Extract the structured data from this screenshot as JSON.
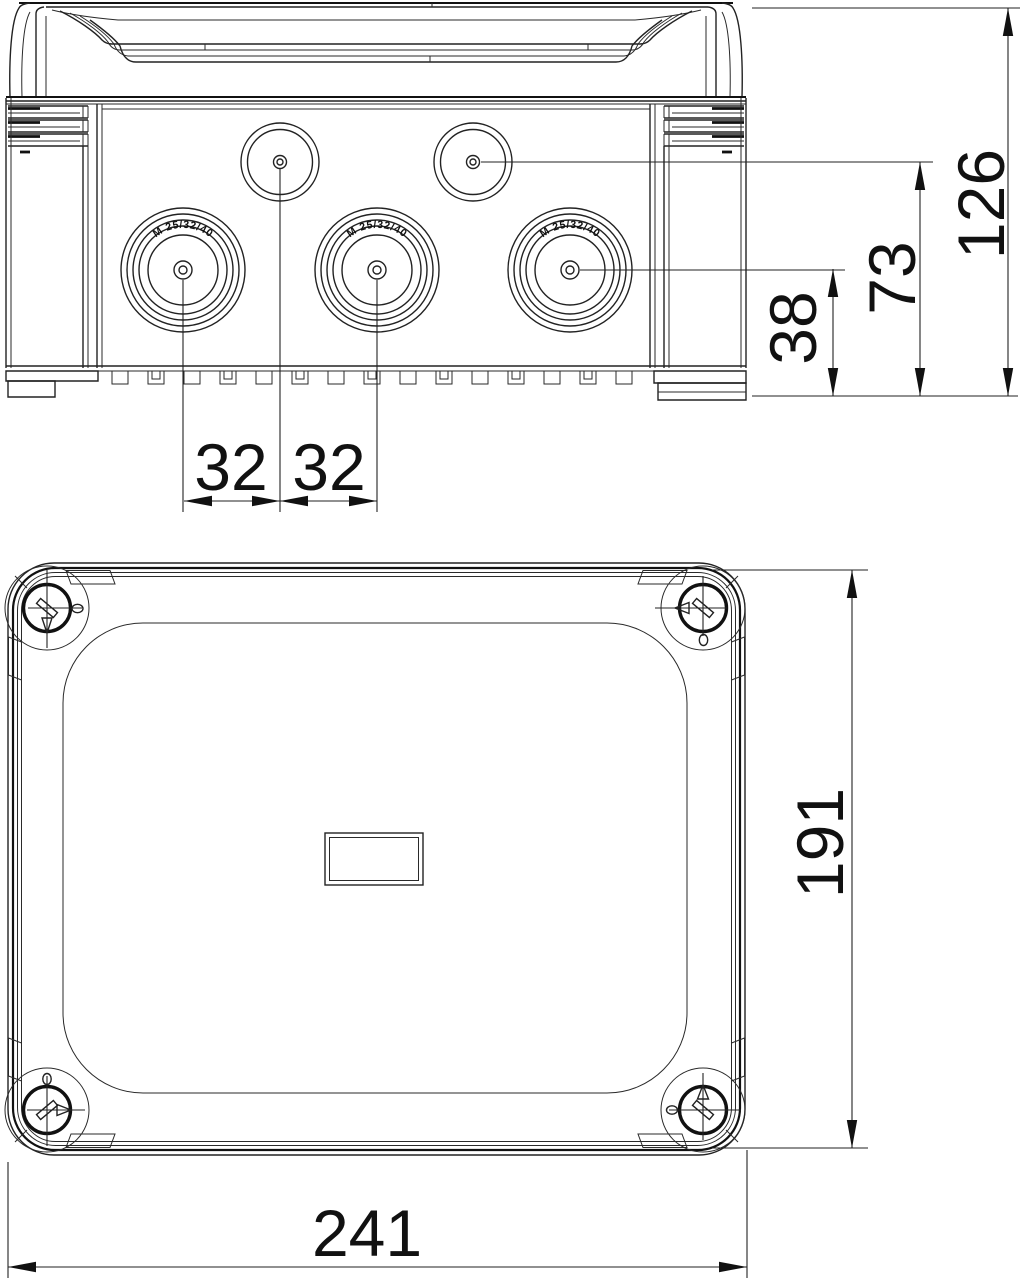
{
  "document": {
    "type": "technical dimension drawing",
    "subject": "junction box with cable entry knockouts, side elevation and top view"
  },
  "side_view": {
    "knockout_labels": {
      "large_1": "M 25/32/40",
      "large_2": "M 25/32/40",
      "large_3": "M 25/32/40"
    },
    "dimensions": {
      "knockout_spacing_left": "32",
      "knockout_spacing_right": "32",
      "large_knockout_center_height": "38",
      "small_knockout_center_height": "73",
      "overall_height": "126"
    }
  },
  "top_view": {
    "dimensions": {
      "overall_depth": "191",
      "overall_width": "241"
    }
  }
}
